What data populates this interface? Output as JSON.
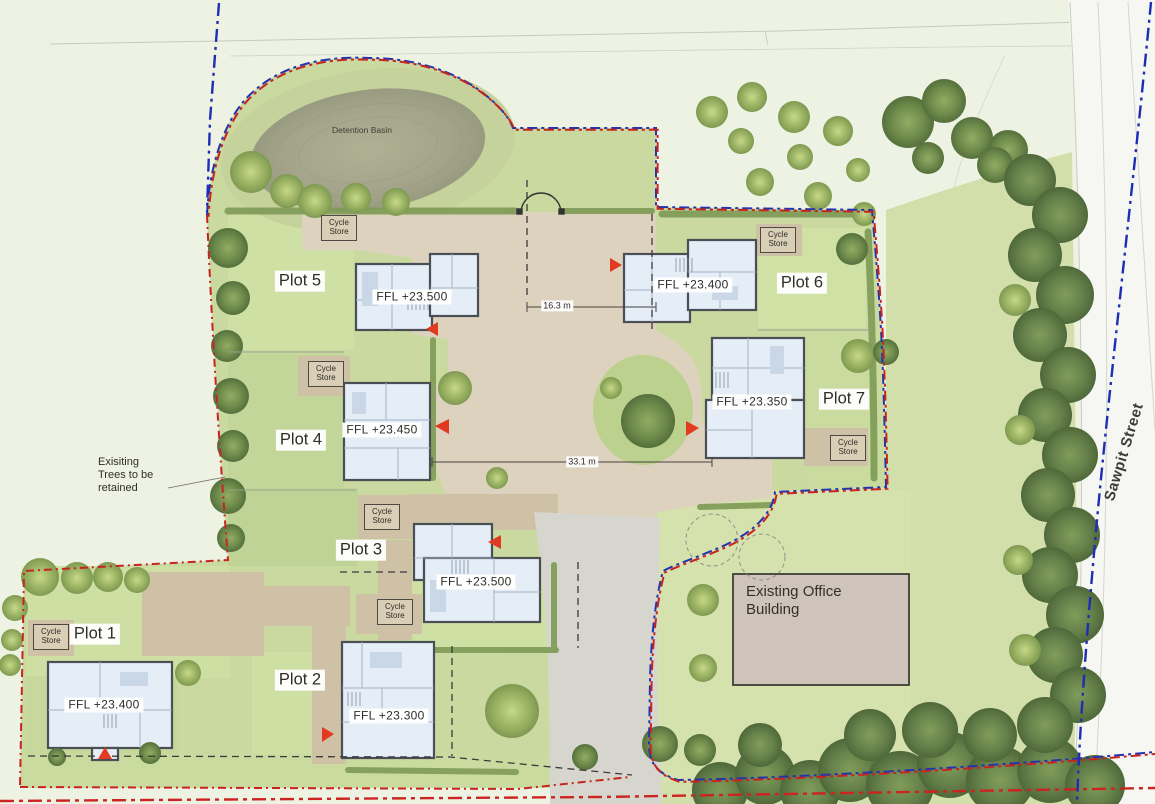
{
  "labels": {
    "detention_basin": "Detention Basin",
    "sawpit_street": "Sawpit Street",
    "existing_office": "Existing Office Building",
    "trees_note": "Exisiting Trees to be retained",
    "cycle_store": "Cycle Store",
    "dim_entrance": "16.3 m",
    "dim_courtyard": "33.1 m"
  },
  "plots": [
    {
      "name": "Plot 1",
      "ffl": "FFL +23.400"
    },
    {
      "name": "Plot 2",
      "ffl": "FFL +23.300"
    },
    {
      "name": "Plot 3",
      "ffl": "FFL +23.500"
    },
    {
      "name": "Plot 4",
      "ffl": "FFL +23.450"
    },
    {
      "name": "Plot 5",
      "ffl": "FFL +23.500"
    },
    {
      "name": "Plot 6",
      "ffl": "FFL +23.400"
    },
    {
      "name": "Plot 7",
      "ffl": "FFL +23.350"
    }
  ],
  "colors": {
    "site_boundary_red": "#c8241f",
    "application_boundary_blue": "#2433ae",
    "entrance_marker_red": "#e23a20",
    "house_fill": "#e5edf6",
    "gravel_drive": "#dcd2bd",
    "office_fill": "#cec4ba"
  }
}
